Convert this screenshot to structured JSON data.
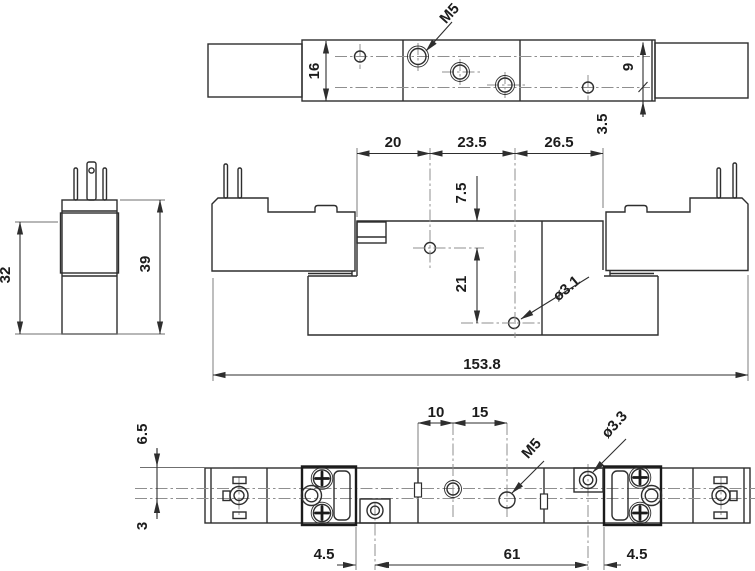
{
  "drawing_type": "valve-dimension-drawing",
  "top_view": {
    "thread_label": "M5",
    "height": "16",
    "row_spacing": "9",
    "edge_offset": "3.5"
  },
  "front_view": {
    "spacing_left": "20",
    "spacing_mid": "23.5",
    "spacing_right": "26.5",
    "pilot_offset": "7.5",
    "port_offset": "21",
    "hole_dia": "ø3.1",
    "overall_length": "153.8"
  },
  "side_view": {
    "body_height": "32",
    "total_height": "39"
  },
  "bottom_view": {
    "top_offset": "6.5",
    "centerline_offset": "3",
    "spacing_a": "10",
    "spacing_b": "15",
    "thread_label": "M5",
    "hole_dia": "ø3.3",
    "offset_left": "4.5",
    "span": "61",
    "offset_right": "4.5"
  },
  "colors": {
    "line": "#2e2e2e",
    "centerline": "#8f8f8f",
    "background": "#ffffff"
  }
}
